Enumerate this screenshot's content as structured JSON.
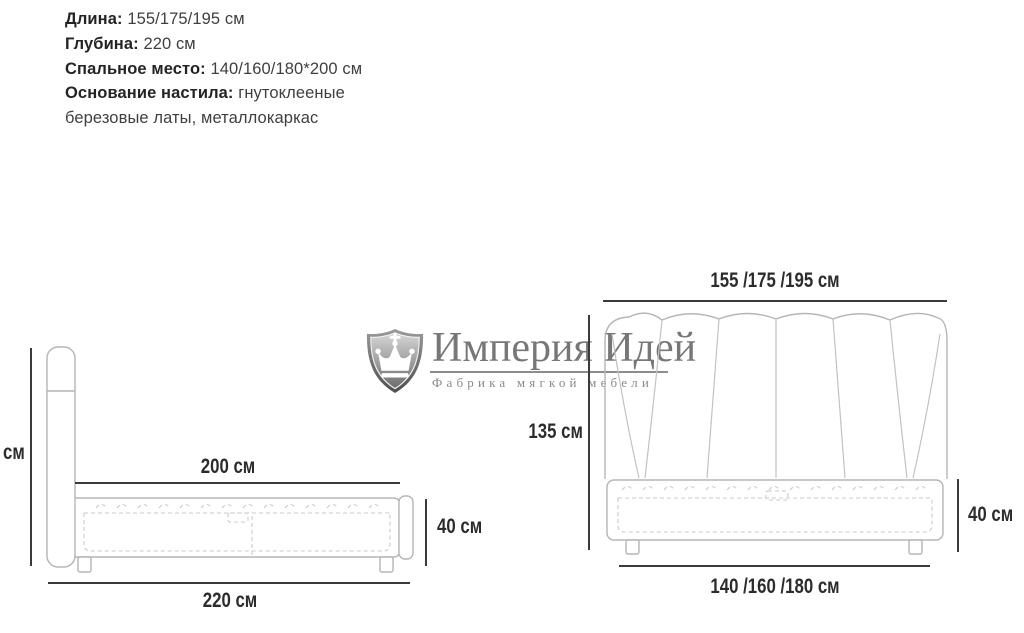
{
  "specs": {
    "items": [
      {
        "label": "Длина:",
        "value": "155/175/195 см"
      },
      {
        "label": "Глубина:",
        "value": "220 см"
      },
      {
        "label": "Спальное место:",
        "value": "140/160/180*200 см"
      },
      {
        "label": "Основание настила:",
        "value": "гнутоклееные березовые латы, металлокаркас"
      }
    ]
  },
  "logo": {
    "brand": "Империя Идей",
    "tagline": "Фабрика мягкой мебели",
    "icon": "crown-shield-icon",
    "gray": "#7d7d7d"
  },
  "side_view": {
    "height_partial_label": "см",
    "mattress_length": "200 см",
    "base_height": "40 см",
    "total_length": "220 см"
  },
  "front_view": {
    "width_top": "155 /175 /195 см",
    "height": "135 см",
    "base_height": "40 см",
    "width_bottom": "140 /160 /180 см"
  },
  "colors": {
    "bed_outline": "#b5b5b5",
    "dashed_detail": "#cacaca",
    "dimension_line": "#3b3b3b",
    "label_text": "#2c2c2c",
    "logo_gray": "#7d7d7d"
  }
}
